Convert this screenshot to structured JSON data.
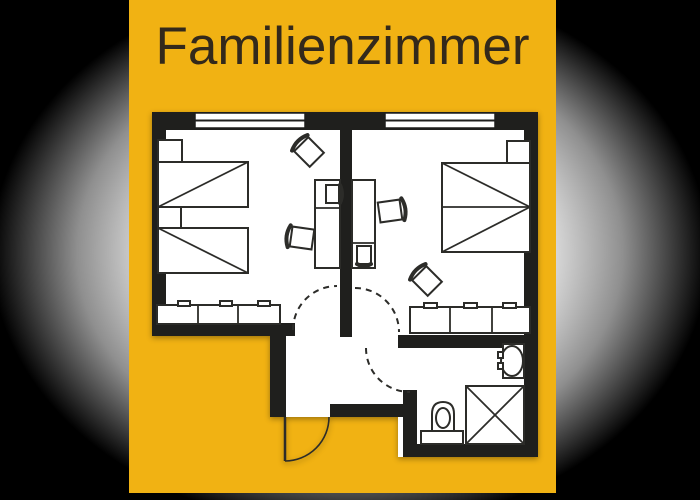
{
  "title": "Familienzimmer",
  "colors": {
    "backdrop": "#000000",
    "glow": "#e9e9e9",
    "card": "#F1B213",
    "wall": "#1f1f1d",
    "floor": "#ffffff",
    "furniture_line": "#2c2c29",
    "title_text": "#33291b"
  },
  "plan": {
    "type": "floor-plan",
    "rooms": [
      {
        "name": "bedroom-left",
        "furniture": [
          "single-bed",
          "single-bed",
          "nightstand",
          "nightstand",
          "wardrobe",
          "desk",
          "chair",
          "chair",
          "chair"
        ],
        "windows": 1,
        "doors": 1
      },
      {
        "name": "bedroom-right",
        "furniture": [
          "double-bed",
          "nightstand",
          "wardrobe",
          "desk",
          "chair",
          "chair"
        ],
        "windows": 1,
        "doors": 1
      },
      {
        "name": "hallway",
        "furniture": [],
        "doors": 1
      },
      {
        "name": "bathroom",
        "furniture": [
          "washbasin",
          "toilet",
          "shower"
        ],
        "doors": 1
      }
    ]
  }
}
